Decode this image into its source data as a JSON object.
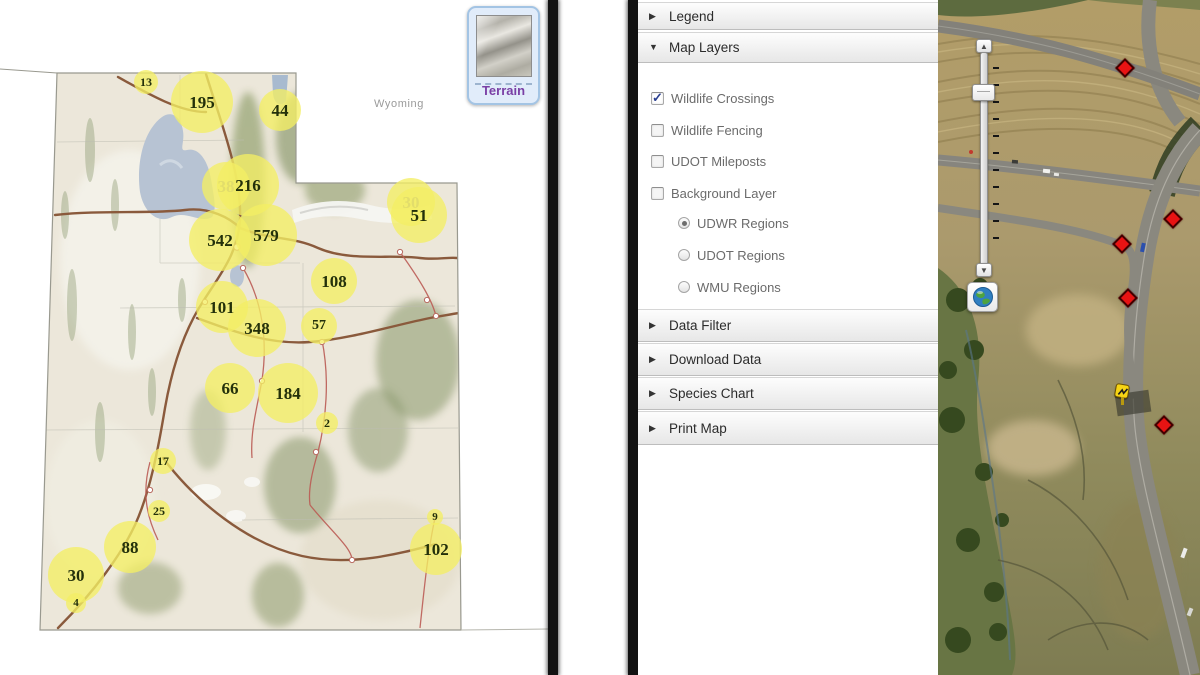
{
  "left_map": {
    "region_label": "Wyoming",
    "basemap_button": {
      "label": "Terrain"
    },
    "clusters": [
      {
        "value": "13",
        "x": 146,
        "y": 82,
        "r": 12
      },
      {
        "value": "195",
        "x": 202,
        "y": 102,
        "r": 31
      },
      {
        "value": "44",
        "x": 280,
        "y": 110,
        "r": 21
      },
      {
        "value": "38",
        "x": 226,
        "y": 186,
        "r": 24,
        "faded": true
      },
      {
        "value": "216",
        "x": 248,
        "y": 185,
        "r": 31
      },
      {
        "value": "542",
        "x": 220,
        "y": 240,
        "r": 31
      },
      {
        "value": "579",
        "x": 266,
        "y": 235,
        "r": 31
      },
      {
        "value": "30",
        "x": 411,
        "y": 202,
        "r": 24,
        "faded": true
      },
      {
        "value": "51",
        "x": 419,
        "y": 215,
        "r": 28
      },
      {
        "value": "108",
        "x": 334,
        "y": 281,
        "r": 23
      },
      {
        "value": "101",
        "x": 222,
        "y": 307,
        "r": 26
      },
      {
        "value": "348",
        "x": 257,
        "y": 328,
        "r": 29
      },
      {
        "value": "57",
        "x": 319,
        "y": 326,
        "r": 18
      },
      {
        "value": "66",
        "x": 230,
        "y": 388,
        "r": 25
      },
      {
        "value": "184",
        "x": 288,
        "y": 393,
        "r": 30
      },
      {
        "value": "2",
        "x": 327,
        "y": 423,
        "r": 11
      },
      {
        "value": "17",
        "x": 163,
        "y": 461,
        "r": 13
      },
      {
        "value": "25",
        "x": 159,
        "y": 511,
        "r": 11
      },
      {
        "value": "88",
        "x": 130,
        "y": 547,
        "r": 26
      },
      {
        "value": "30",
        "x": 76,
        "y": 575,
        "r": 28
      },
      {
        "value": "4",
        "x": 76,
        "y": 603,
        "r": 10
      },
      {
        "value": "9",
        "x": 435,
        "y": 517,
        "r": 8
      },
      {
        "value": "102",
        "x": 436,
        "y": 549,
        "r": 26
      }
    ]
  },
  "panel": {
    "sections": [
      {
        "label": "Legend",
        "expanded": false
      },
      {
        "label": "Map Layers",
        "expanded": true
      }
    ],
    "map_layers": {
      "checkboxes": [
        {
          "label": "Wildlife Crossings",
          "checked": true
        },
        {
          "label": "Wildlife Fencing",
          "checked": false
        },
        {
          "label": "UDOT Mileposts",
          "checked": false
        },
        {
          "label": "Background Layer",
          "checked": false
        }
      ],
      "radios": [
        {
          "label": "UDWR Regions",
          "selected": true
        },
        {
          "label": "UDOT Regions",
          "selected": false
        },
        {
          "label": "WMU Regions",
          "selected": false
        }
      ]
    },
    "collapsed_sections": [
      {
        "label": "Data Filter"
      },
      {
        "label": "Download Data"
      },
      {
        "label": "Species Chart"
      },
      {
        "label": "Print Map"
      }
    ]
  },
  "aerial_map": {
    "crossing_markers": [
      {
        "x": 1127,
        "y": 70
      },
      {
        "x": 1175,
        "y": 221
      },
      {
        "x": 1124,
        "y": 246
      },
      {
        "x": 1130,
        "y": 300
      },
      {
        "x": 1166,
        "y": 427
      }
    ],
    "sign_marker": {
      "x": 1122,
      "y": 391
    },
    "zoom_slider": {
      "tick_count": 11
    }
  },
  "colors": {
    "cluster_fill": "rgba(243,238,100,0.78)",
    "cluster_text": "#23300a",
    "cluster_text_faded": "#a3a184",
    "marker_red": "#e81313",
    "check_blue": "#2b3f91",
    "terrain_label": "#7a3fa5"
  }
}
